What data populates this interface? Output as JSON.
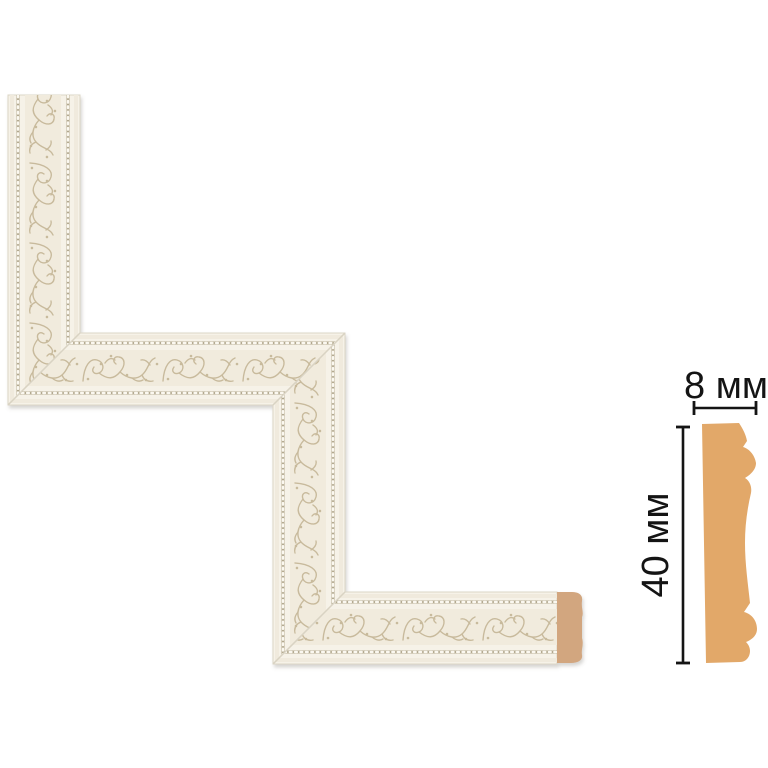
{
  "image": {
    "description": "Decorative corner molding element with ornate floral relief, end cap, and side profile cross-section with dimensions"
  },
  "dimensions": {
    "width_label": "8 мм",
    "height_label": "40 мм"
  },
  "colors": {
    "background": "#ffffff",
    "molding_base": "#f6f2e8",
    "pattern_band_bg": "#f1ebdd",
    "ornament": "#c8ba9c",
    "bead_line": "#b2a88e",
    "bead_dot": "#fbf8f0",
    "end_cap": "#d2a67f",
    "profile": "#e2a869",
    "dimension": "#141414"
  }
}
